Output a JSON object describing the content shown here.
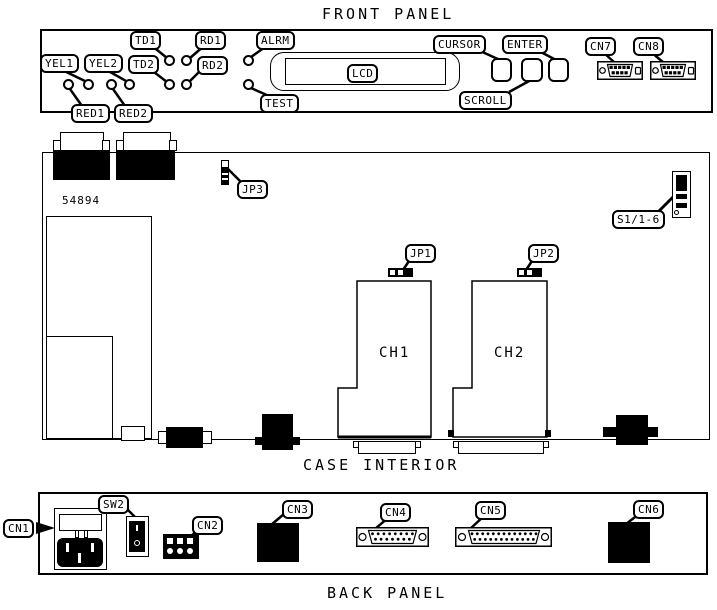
{
  "titles": {
    "front_panel": "FRONT PANEL",
    "case_interior": "CASE INTERIOR",
    "back_panel": "BACK PANEL"
  },
  "front_panel": {
    "led_labels": {
      "td1": "TD1",
      "rd1": "RD1",
      "alrm": "ALRM",
      "yel1": "YEL1",
      "yel2": "YEL2",
      "td2": "TD2",
      "rd2": "RD2",
      "red1": "RED1",
      "red2": "RED2",
      "test": "TEST"
    },
    "lcd_label": "LCD",
    "button_labels": {
      "cursor": "CURSOR",
      "enter": "ENTER",
      "scroll": "SCROLL"
    },
    "connector_labels": {
      "cn7": "CN7",
      "cn8": "CN8"
    }
  },
  "case_interior": {
    "board_number": "54894",
    "jumper_labels": {
      "jp1": "JP1",
      "jp2": "JP2",
      "jp3": "JP3"
    },
    "dip_switch_label": "S1/1-6",
    "channel_labels": {
      "ch1": "CH1",
      "ch2": "CH2"
    }
  },
  "back_panel": {
    "switch_label": "SW2",
    "connector_labels": {
      "cn1": "CN1",
      "cn2": "CN2",
      "cn3": "CN3",
      "cn4": "CN4",
      "cn5": "CN5",
      "cn6": "CN6"
    }
  },
  "colors": {
    "line": "#000000",
    "background": "#ffffff"
  }
}
